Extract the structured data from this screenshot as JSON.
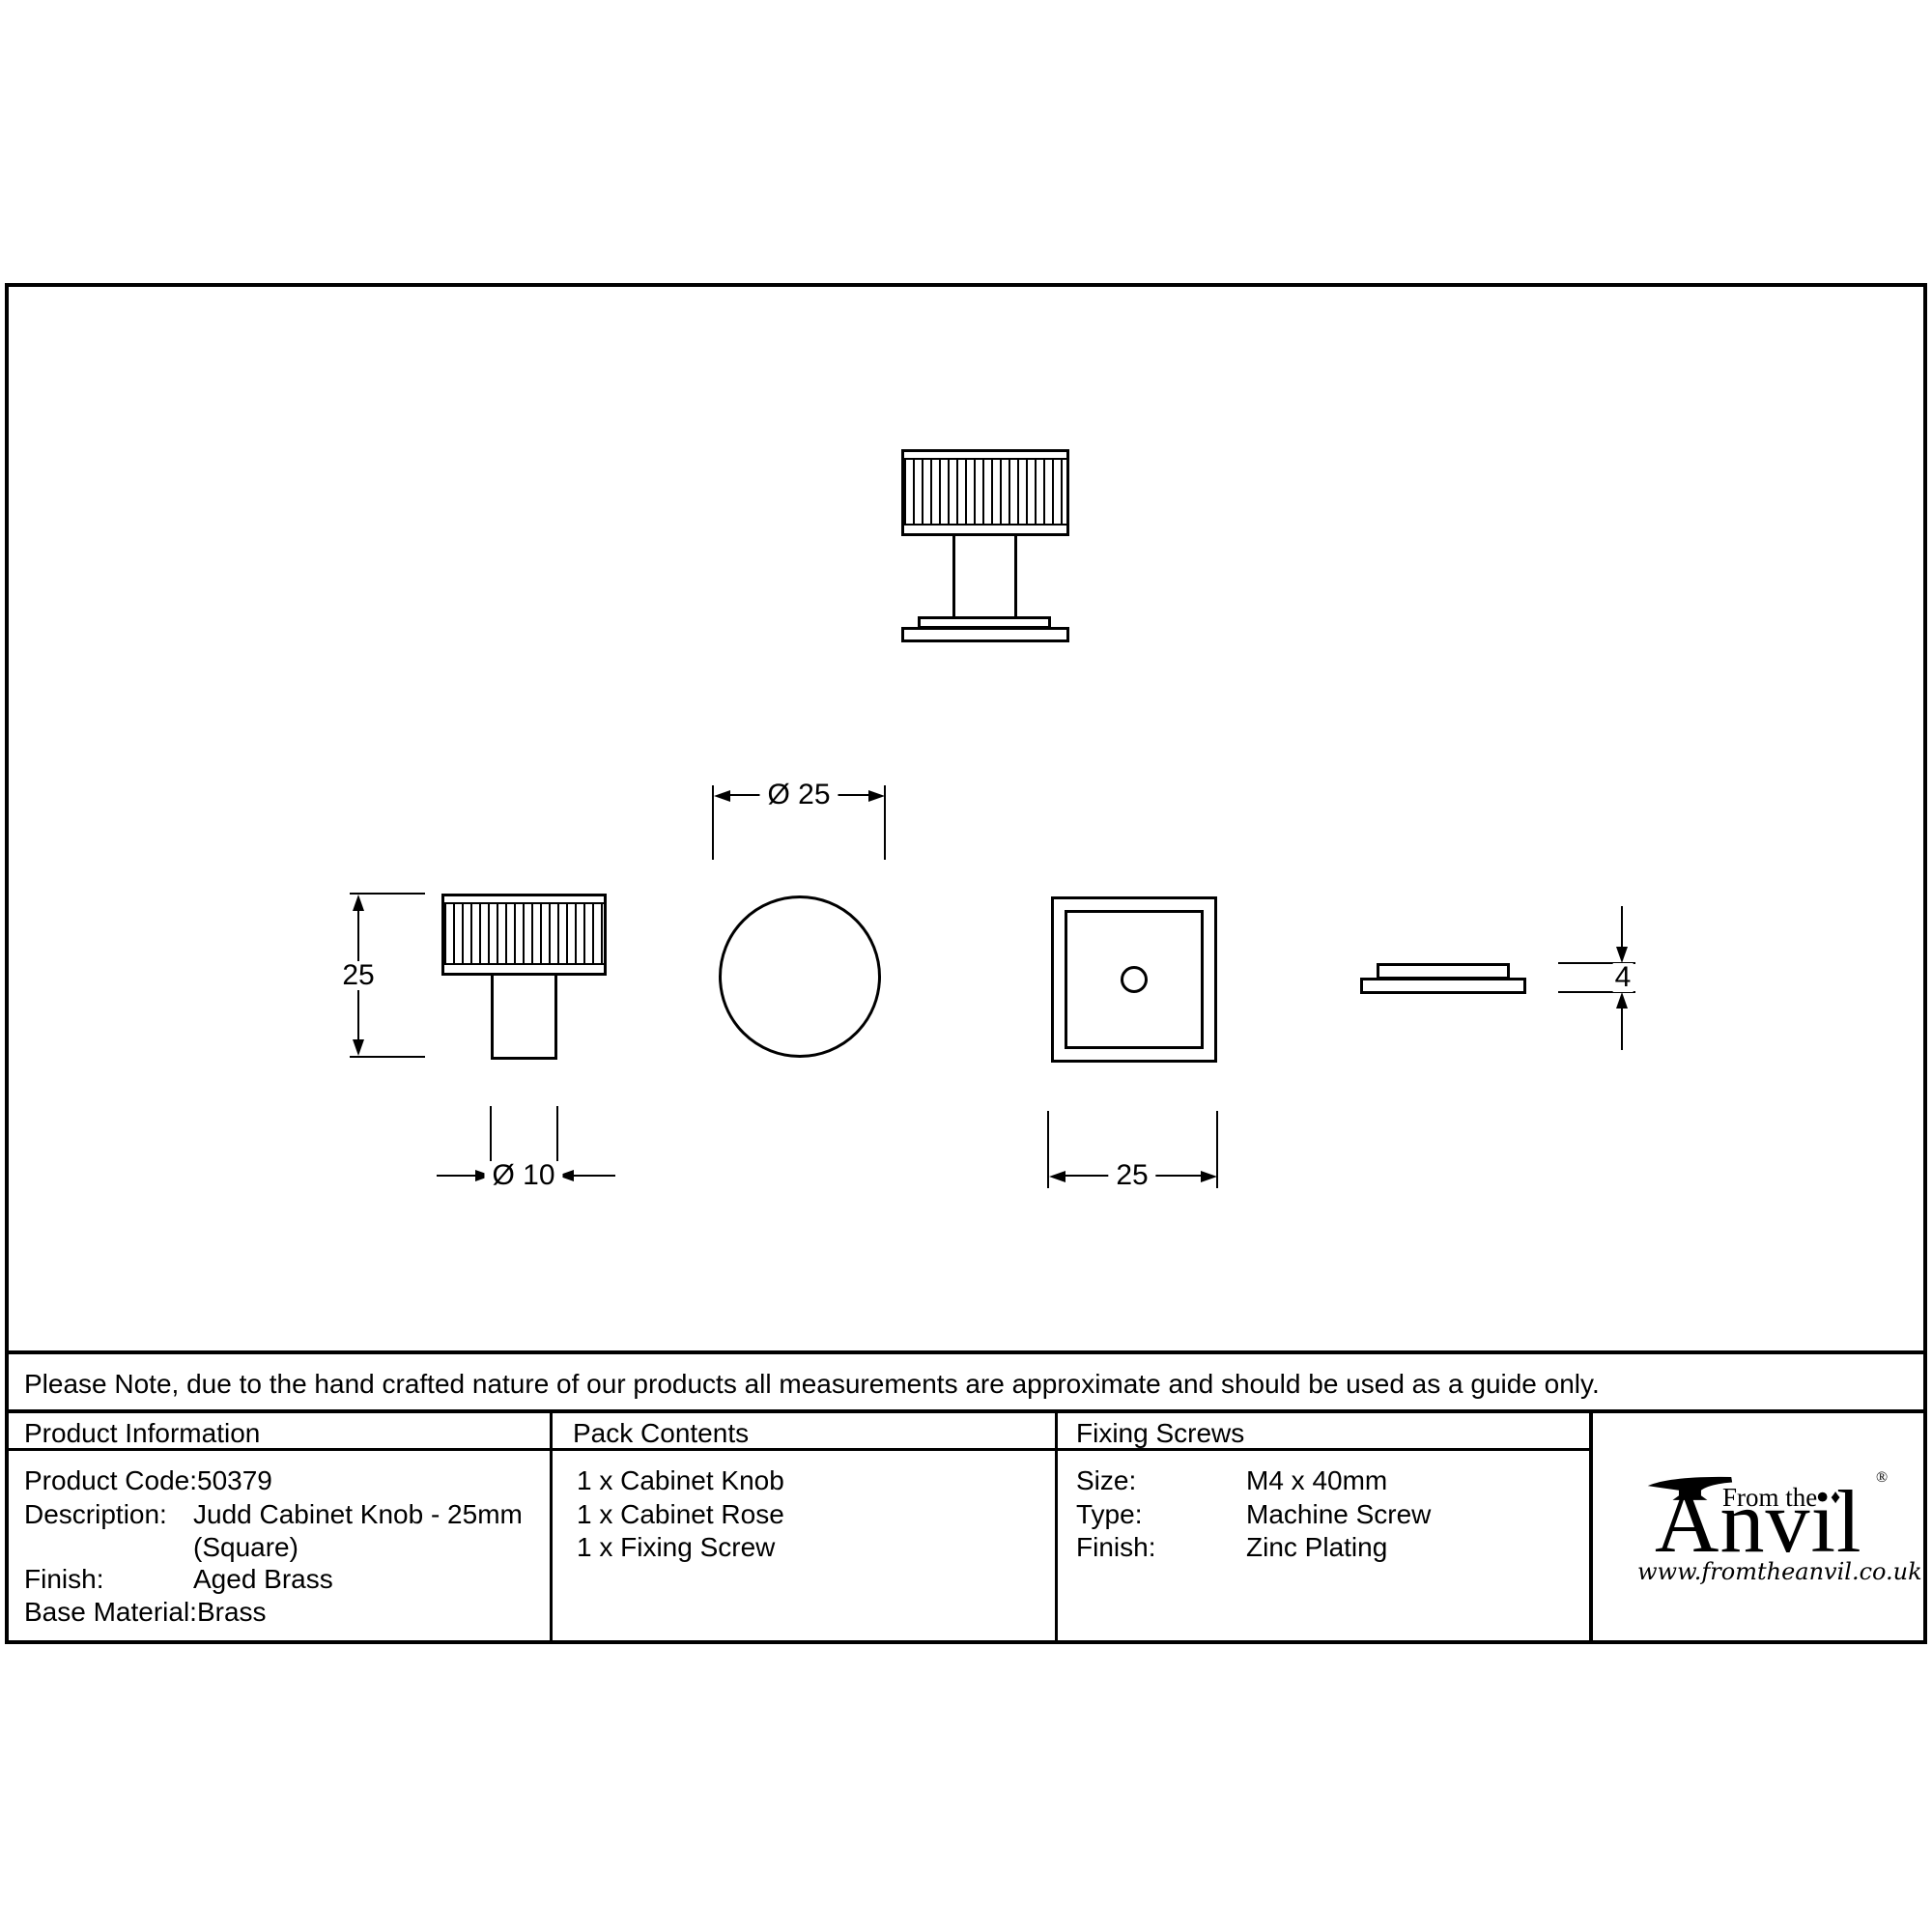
{
  "note": "Please Note, due to the hand crafted nature of our products all measurements are approximate and should be used as a guide only.",
  "dims": {
    "knob_height": "25",
    "stem_diameter": "Ø 10",
    "knob_diameter": "Ø 25",
    "rose_width": "25",
    "rose_thickness": "4"
  },
  "table": {
    "product_information": {
      "header": "Product Information",
      "rows": [
        {
          "label": "Product Code:",
          "value": "50379"
        },
        {
          "label": "Description:",
          "value": "Judd Cabinet Knob - 25mm"
        },
        {
          "label": "",
          "value": "(Square)"
        },
        {
          "label": "Finish:",
          "value": "Aged Brass"
        },
        {
          "label": "Base Material:",
          "value": "Brass"
        }
      ]
    },
    "pack_contents": {
      "header": "Pack Contents",
      "items": [
        "1 x Cabinet Knob",
        "1 x Cabinet Rose",
        "1 x Fixing Screw"
      ]
    },
    "fixing_screws": {
      "header": "Fixing Screws",
      "rows": [
        {
          "label": "Size:",
          "value": "M4 x 40mm"
        },
        {
          "label": "Type:",
          "value": "Machine Screw"
        },
        {
          "label": "Finish:",
          "value": "Zinc Plating"
        }
      ]
    }
  },
  "logo": {
    "tagline": "From the",
    "brand": "Anvil",
    "diamond": "♦",
    "registered": "®",
    "website": "www.fromtheanvil.co.uk"
  },
  "colors": {
    "line": "#000000",
    "background": "#ffffff"
  }
}
